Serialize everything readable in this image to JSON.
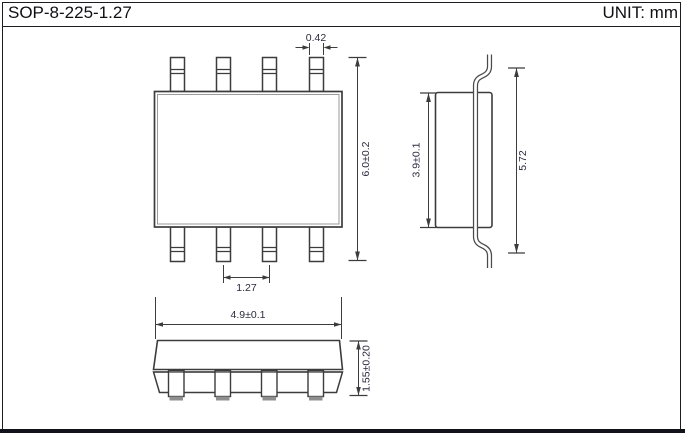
{
  "header": {
    "title": "SOP-8-225-1.27",
    "unit": "UNIT: mm"
  },
  "dimensions": {
    "pin_width": "0.42",
    "lead_span_total": "6.0±0.2",
    "pin_pitch": "1.27",
    "body_width": "3.9±0.1",
    "lead_tip_span": "5.72",
    "body_length": "4.9±0.1",
    "package_height": "1.55±0.20"
  },
  "colors": {
    "line": "#3c3c3c",
    "inner_line": "#9a9a9a",
    "dim_text": "#2a2a3e",
    "frame": "#1c1c22",
    "footer_bar": "#12121a",
    "foot_shade": "#8f8f8f"
  }
}
